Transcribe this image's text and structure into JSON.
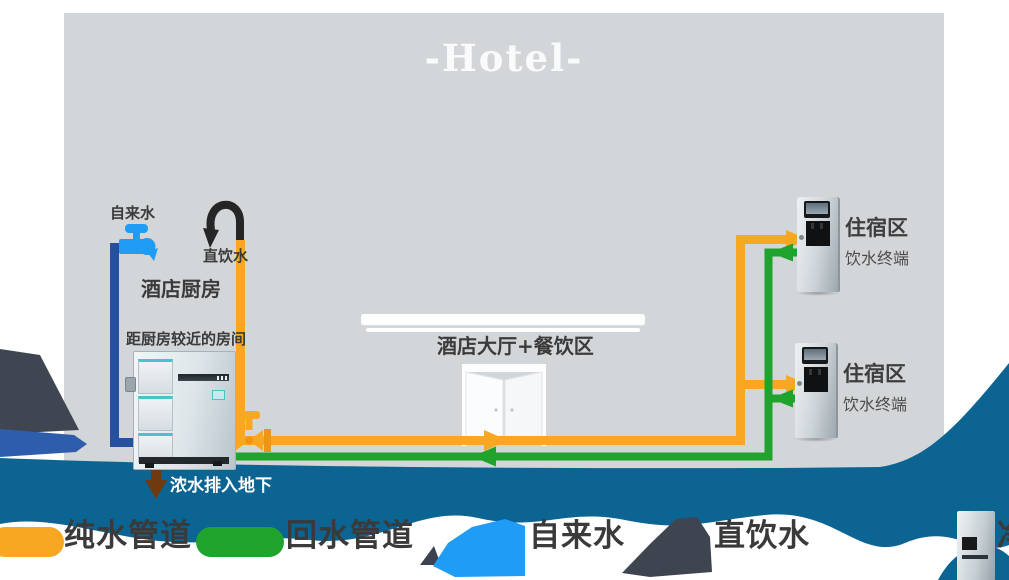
{
  "title": "-Hotel-",
  "colors": {
    "building_gray": "#d3d6d9",
    "underground_teal": "#0c6492",
    "pure_water_orange": "#f7a722",
    "return_water_green": "#1fa32c",
    "tap_water_navy": "#24509d",
    "tap_faucet_blue": "#1f9cf5",
    "drain_brown": "#6f3a10"
  },
  "diagram": {
    "tap_water_label": "自来水",
    "direct_water_label": "直饮水",
    "kitchen_label": "酒店厨房",
    "near_room_label": "距厨房较近的房间",
    "lobby_label": "酒店大厅+餐饮区",
    "drain_label": "浓水排入地下",
    "dispensers": [
      {
        "area": "住宿区",
        "terminal": "饮水终端"
      },
      {
        "area": "住宿区",
        "terminal": "饮水终端"
      }
    ]
  },
  "legend": {
    "items": [
      {
        "icon": "orange-line",
        "label": "纯水管道",
        "color": "#f7a722"
      },
      {
        "icon": "green-line",
        "label": "回水管道",
        "color": "#1fa32c"
      },
      {
        "icon": "blue-faucet",
        "label": "自来水",
        "color": "#1f9cf5"
      },
      {
        "icon": "dark-faucet",
        "label": "直饮水",
        "color": "#3e4450"
      },
      {
        "icon": "purifier-machine",
        "label": "净水设备",
        "color": "#c6cfd4"
      }
    ]
  }
}
